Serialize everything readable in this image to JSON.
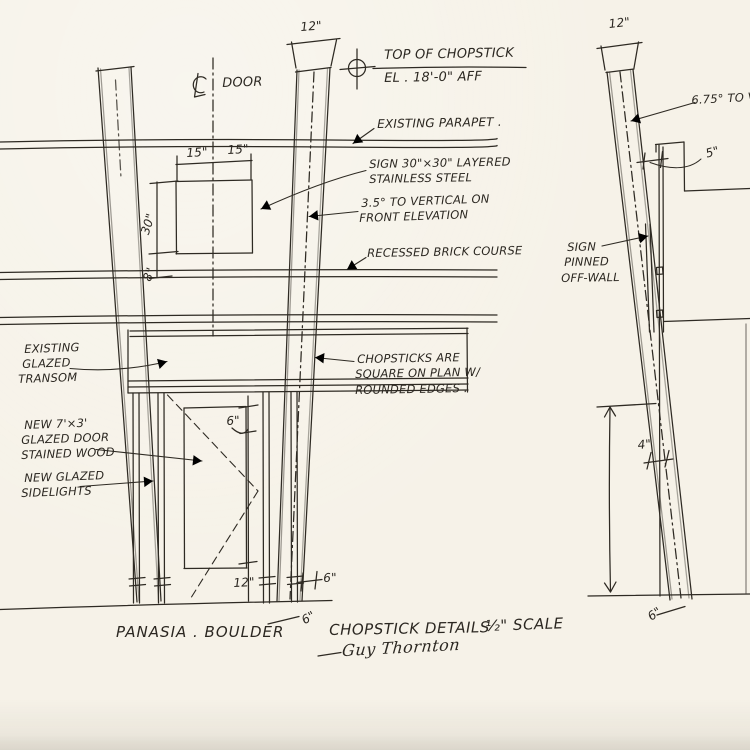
{
  "paper": {
    "background": "#f6f2e8",
    "ink": "#2e2a23"
  },
  "icons": {
    "elevation_marker": "crosshair-circle-icon",
    "door_centerline_prefix": "℄"
  },
  "title_block": {
    "project": "PANASIA . BOULDER",
    "drawing_title": "CHOPSTICK DETAILS",
    "scale": "½\" SCALE",
    "signature": "Guy Thornton"
  },
  "front_elevation": {
    "labels": {
      "door_centerline": "DOOR",
      "top_of_chopstick_line1": "TOP OF CHOPSTICK",
      "top_of_chopstick_line2": "EL . 18'-0\" AFF",
      "existing_parapet": "EXISTING PARAPET .",
      "sign_line1": "SIGN 30\"×30\" LAYERED",
      "sign_line2": "STAINLESS STEEL",
      "angle_line1": "3.5° TO VERTICAL ON",
      "angle_line2": "FRONT ELEVATION",
      "recessed_brick": "RECESSED BRICK COURSE",
      "chopsticks_line1": "CHOPSTICKS ARE",
      "chopsticks_line2": "SQUARE ON PLAN W/",
      "chopsticks_line3": "ROUNDED EDGES .",
      "transom_line1": "EXISTING",
      "transom_line2": "GLAZED",
      "transom_line3": "TRANSOM",
      "door_line1": "NEW 7'×3'",
      "door_line2": "GLAZED DOOR",
      "door_line3": "STAINED WOOD",
      "sidelights_line1": "NEW GLAZED",
      "sidelights_line2": "SIDELIGHTS"
    },
    "dimensions": {
      "chopstick_top": "12\"",
      "sign_left_half": "15\"",
      "sign_right_half": "15\"",
      "sign_height": "30\"",
      "sign_to_brick": "8\"",
      "door_head": "6\"",
      "door_kick": "12\"",
      "jamb_to_chopstick": "6\"",
      "chopstick_base": "6\""
    }
  },
  "side_elevation": {
    "labels": {
      "angle": "6.75° TO VE",
      "sign_line1": "SIGN",
      "sign_line2": "PINNED",
      "sign_line3": "OFF-WALL"
    },
    "dimensions": {
      "chopstick_top": "12\"",
      "sign_off_wall": "5\"",
      "chopstick_mid": "4\"",
      "chopstick_base": "6\""
    }
  }
}
